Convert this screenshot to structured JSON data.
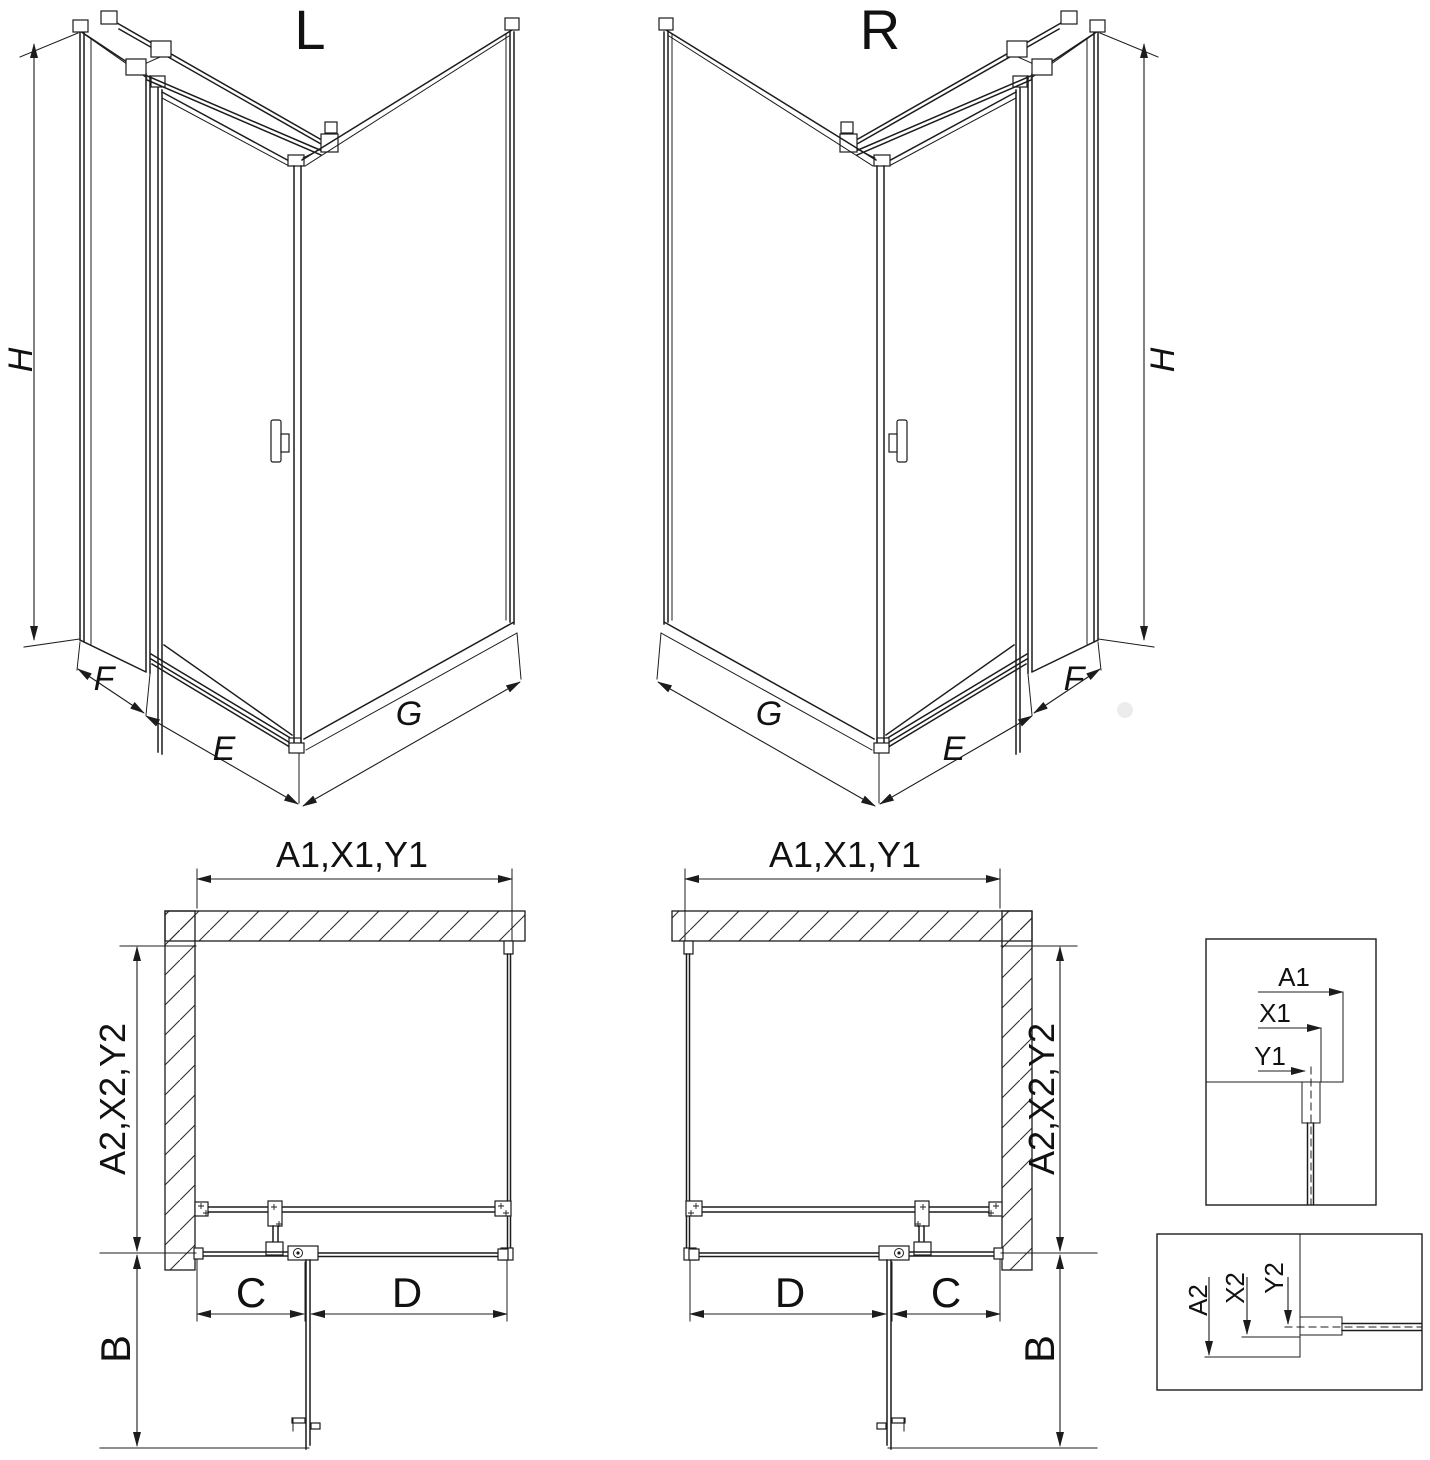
{
  "drawing": {
    "type": "shower-enclosure-installation-diagram",
    "colors": {
      "line": "#1c1c1c",
      "background": "#ffffff",
      "hatch": "#303030"
    },
    "iso_left": {
      "title": "L",
      "dim_height": "H",
      "dim_return_panel": "F",
      "dim_front": "E",
      "dim_side": "G"
    },
    "iso_right": {
      "title": "R",
      "dim_height": "H",
      "dim_return_panel": "F",
      "dim_front": "E",
      "dim_side": "G"
    },
    "plan_left": {
      "dim_top": "A1,X1,Y1",
      "dim_side": "A2,X2,Y2",
      "dim_door": "B",
      "dim_hinge": "C",
      "dim_fixed": "D"
    },
    "plan_right": {
      "dim_top": "A1,X1,Y1",
      "dim_side": "A2,X2,Y2",
      "dim_door": "B",
      "dim_hinge": "C",
      "dim_fixed": "D"
    },
    "detail_top": {
      "dim_a": "A1",
      "dim_x": "X1",
      "dim_y": "Y1"
    },
    "detail_bottom": {
      "dim_a": "A2",
      "dim_x": "X2",
      "dim_y": "Y2"
    }
  }
}
